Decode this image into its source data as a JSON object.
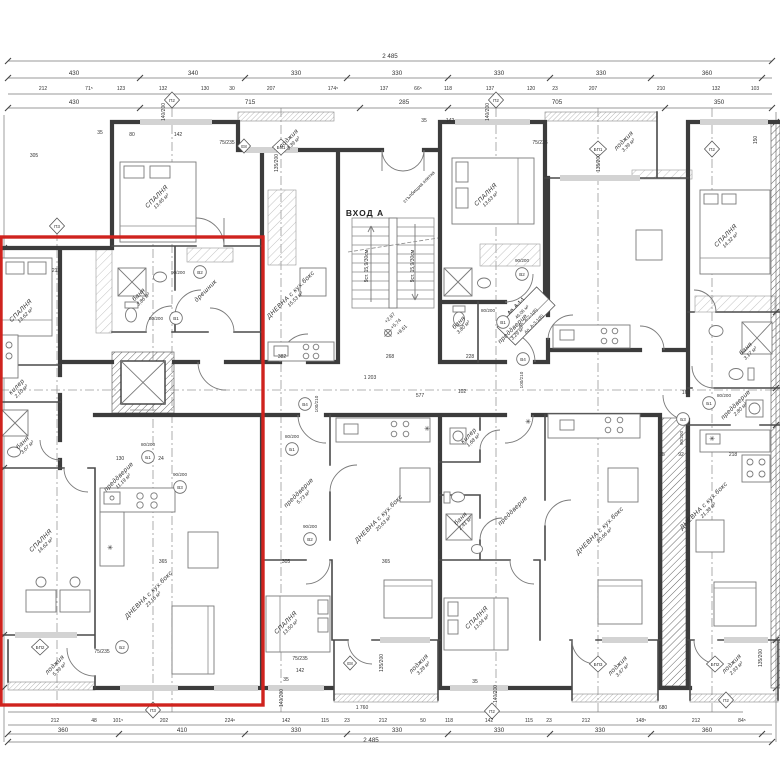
{
  "colors": {
    "highlight": "#cf231e",
    "wall": "#3c3c3c",
    "line": "#777777",
    "text": "#333333"
  },
  "entrance": {
    "label": "ВХОД А"
  },
  "annotations": [
    {
      "t": "2 485",
      "x": 390,
      "y": 58,
      "c": "dim",
      "n": "overall-dimension-top"
    },
    {
      "t": "430",
      "x": 74,
      "y": 75,
      "c": "dim"
    },
    {
      "t": "340",
      "x": 193,
      "y": 75,
      "c": "dim"
    },
    {
      "t": "330",
      "x": 296,
      "y": 75,
      "c": "dim"
    },
    {
      "t": "330",
      "x": 397,
      "y": 75,
      "c": "dim"
    },
    {
      "t": "330",
      "x": 499,
      "y": 75,
      "c": "dim"
    },
    {
      "t": "330",
      "x": 601,
      "y": 75,
      "c": "dim"
    },
    {
      "t": "360",
      "x": 707,
      "y": 75,
      "c": "dim"
    },
    {
      "t": "212",
      "x": 43,
      "y": 90,
      "c": "sm"
    },
    {
      "t": "71⁵",
      "x": 89,
      "y": 90,
      "c": "sm"
    },
    {
      "t": "123",
      "x": 121,
      "y": 90,
      "c": "sm"
    },
    {
      "t": "132",
      "x": 163,
      "y": 90,
      "c": "sm"
    },
    {
      "t": "130",
      "x": 205,
      "y": 90,
      "c": "sm"
    },
    {
      "t": "30",
      "x": 232,
      "y": 90,
      "c": "sm"
    },
    {
      "t": "207",
      "x": 271,
      "y": 90,
      "c": "sm"
    },
    {
      "t": "174⁵",
      "x": 333,
      "y": 90,
      "c": "sm"
    },
    {
      "t": "137",
      "x": 384,
      "y": 90,
      "c": "sm"
    },
    {
      "t": "66⁵",
      "x": 418,
      "y": 90,
      "c": "sm"
    },
    {
      "t": "118",
      "x": 448,
      "y": 90,
      "c": "sm"
    },
    {
      "t": "137",
      "x": 490,
      "y": 90,
      "c": "sm"
    },
    {
      "t": "120",
      "x": 531,
      "y": 90,
      "c": "sm"
    },
    {
      "t": "23",
      "x": 555,
      "y": 90,
      "c": "sm"
    },
    {
      "t": "207",
      "x": 593,
      "y": 90,
      "c": "sm"
    },
    {
      "t": "210",
      "x": 661,
      "y": 90,
      "c": "sm"
    },
    {
      "t": "132",
      "x": 716,
      "y": 90,
      "c": "sm"
    },
    {
      "t": "103",
      "x": 755,
      "y": 90,
      "c": "sm"
    },
    {
      "t": "430",
      "x": 74,
      "y": 104,
      "c": "dim"
    },
    {
      "t": "715",
      "x": 250,
      "y": 104,
      "c": "dim"
    },
    {
      "t": "285",
      "x": 404,
      "y": 104,
      "c": "dim"
    },
    {
      "t": "705",
      "x": 557,
      "y": 104,
      "c": "dim"
    },
    {
      "t": "350",
      "x": 719,
      "y": 104,
      "c": "dim"
    },
    {
      "t": "1 760",
      "x": 362,
      "y": 709,
      "c": "sm"
    },
    {
      "t": "680",
      "x": 663,
      "y": 709,
      "c": "sm"
    },
    {
      "t": "212",
      "x": 55,
      "y": 722,
      "c": "sm"
    },
    {
      "t": "48",
      "x": 94,
      "y": 722,
      "c": "sm"
    },
    {
      "t": "101⁵",
      "x": 118,
      "y": 722,
      "c": "sm"
    },
    {
      "t": "202",
      "x": 164,
      "y": 722,
      "c": "sm"
    },
    {
      "t": "224⁶",
      "x": 230,
      "y": 722,
      "c": "sm"
    },
    {
      "t": "142",
      "x": 286,
      "y": 722,
      "c": "sm"
    },
    {
      "t": "115",
      "x": 325,
      "y": 722,
      "c": "sm"
    },
    {
      "t": "23",
      "x": 347,
      "y": 722,
      "c": "sm"
    },
    {
      "t": "212",
      "x": 383,
      "y": 722,
      "c": "sm"
    },
    {
      "t": "50",
      "x": 423,
      "y": 722,
      "c": "sm"
    },
    {
      "t": "118",
      "x": 449,
      "y": 722,
      "c": "sm"
    },
    {
      "t": "142",
      "x": 489,
      "y": 722,
      "c": "sm"
    },
    {
      "t": "115",
      "x": 529,
      "y": 722,
      "c": "sm"
    },
    {
      "t": "23",
      "x": 549,
      "y": 722,
      "c": "sm"
    },
    {
      "t": "212",
      "x": 586,
      "y": 722,
      "c": "sm"
    },
    {
      "t": "148⁵",
      "x": 641,
      "y": 722,
      "c": "sm"
    },
    {
      "t": "212",
      "x": 696,
      "y": 722,
      "c": "sm"
    },
    {
      "t": "84⁵",
      "x": 742,
      "y": 722,
      "c": "sm"
    },
    {
      "t": "360",
      "x": 63,
      "y": 732,
      "c": "dim"
    },
    {
      "t": "410",
      "x": 182,
      "y": 732,
      "c": "dim"
    },
    {
      "t": "330",
      "x": 296,
      "y": 732,
      "c": "dim"
    },
    {
      "t": "330",
      "x": 397,
      "y": 732,
      "c": "dim"
    },
    {
      "t": "330",
      "x": 499,
      "y": 732,
      "c": "dim"
    },
    {
      "t": "330",
      "x": 600,
      "y": 732,
      "c": "dim"
    },
    {
      "t": "360",
      "x": 707,
      "y": 732,
      "c": "dim"
    },
    {
      "t": "2 485",
      "x": 371,
      "y": 742,
      "c": "dim",
      "n": "overall-dimension-bottom"
    },
    {
      "t": "СПАЛНЯ",
      "t2": "13,62 м²",
      "x": 22,
      "y": 312,
      "r": -45,
      "c": "room",
      "n": "room-label"
    },
    {
      "t": "СПАЛНЯ",
      "t2": "13,45 м²",
      "x": 158,
      "y": 198,
      "r": -45,
      "c": "room",
      "n": "room-label"
    },
    {
      "t": "лоджия",
      "t2": "3,39 м²",
      "x": 290,
      "y": 140,
      "r": -45,
      "c": "room",
      "n": "room-label"
    },
    {
      "t": "ДНЕВНА с кух.бокс",
      "t2": "15,53 м²",
      "x": 292,
      "y": 296,
      "r": -45,
      "c": "room",
      "n": "room-label"
    },
    {
      "t": "СПАЛНЯ",
      "t2": "13,63 м²",
      "x": 487,
      "y": 196,
      "r": -45,
      "c": "room",
      "n": "room-label"
    },
    {
      "t": "лоджия",
      "t2": "3,39 м²",
      "x": 625,
      "y": 142,
      "r": -45,
      "c": "room",
      "n": "room-label"
    },
    {
      "t": "СПАЛНЯ",
      "t2": "14,32 м²",
      "x": 727,
      "y": 237,
      "r": -45,
      "c": "room",
      "n": "room-label"
    },
    {
      "t": "баня",
      "t2": "3,86 м²",
      "x": 140,
      "y": 296,
      "r": -45,
      "c": "room",
      "n": "room-label"
    },
    {
      "t": "дрешник",
      "x": 207,
      "y": 292,
      "r": -45,
      "c": "room",
      "n": "room-label"
    },
    {
      "t": "баня",
      "t2": "3,80 м²",
      "x": 460,
      "y": 324,
      "r": -45,
      "c": "room",
      "n": "room-label"
    },
    {
      "t": "преддверие",
      "t2": "3,29 м²",
      "x": 514,
      "y": 330,
      "r": -45,
      "c": "room",
      "n": "room-label"
    },
    {
      "t": "баня",
      "t2": "3,17 м²",
      "x": 747,
      "y": 350,
      "r": -45,
      "c": "room",
      "n": "room-label"
    },
    {
      "t": "преддверие",
      "t2": "2,80 м²",
      "x": 737,
      "y": 406,
      "r": -45,
      "c": "room",
      "n": "room-label"
    },
    {
      "t": "килер",
      "t2": "2,10 м²",
      "x": 18,
      "y": 388,
      "r": -45,
      "c": "room",
      "n": "room-label"
    },
    {
      "t": "баня",
      "t2": "3,67 м²",
      "x": 24,
      "y": 444,
      "r": -45,
      "c": "room",
      "n": "room-label"
    },
    {
      "t": "преддверие",
      "t2": "11,19 м²",
      "x": 120,
      "y": 478,
      "r": -45,
      "c": "room",
      "n": "room-label"
    },
    {
      "t": "СПАЛНЯ",
      "t2": "14,62 м²",
      "x": 42,
      "y": 542,
      "r": -45,
      "c": "room",
      "n": "room-label"
    },
    {
      "t": "ДНЕВНА с кух.бокс",
      "t2": "23,16 м²",
      "x": 150,
      "y": 596,
      "r": -45,
      "c": "room",
      "n": "room-label"
    },
    {
      "t": "лоджия",
      "t2": "5,39 м²",
      "x": 56,
      "y": 666,
      "r": -45,
      "c": "room",
      "n": "room-label"
    },
    {
      "t": "преддверие",
      "t2": "5,73 м²",
      "x": 300,
      "y": 494,
      "r": -45,
      "c": "room",
      "n": "room-label"
    },
    {
      "t": "ДНЕВНА с кух.бокс",
      "t2": "20,63 м²",
      "x": 380,
      "y": 520,
      "r": -45,
      "c": "room",
      "n": "room-label"
    },
    {
      "t": "килер",
      "t2": "1,68 м²",
      "x": 470,
      "y": 437,
      "r": -45,
      "c": "room",
      "n": "room-label"
    },
    {
      "t": "баня",
      "t2": "2,41 м²",
      "x": 462,
      "y": 520,
      "r": -45,
      "c": "room",
      "n": "room-label"
    },
    {
      "t": "СПАЛНЯ",
      "t2": "13,50 м²",
      "x": 287,
      "y": 624,
      "r": -45,
      "c": "room",
      "n": "room-label"
    },
    {
      "t": "лоджия",
      "t2": "3,28 м²",
      "x": 420,
      "y": 665,
      "r": -45,
      "c": "room",
      "n": "room-label"
    },
    {
      "t": "СПАЛНЯ",
      "t2": "13,04 м²",
      "x": 478,
      "y": 619,
      "r": -45,
      "c": "room",
      "n": "room-label"
    },
    {
      "t": "преддверие",
      "x": 514,
      "y": 512,
      "r": -45,
      "c": "room",
      "n": "room-label"
    },
    {
      "t": "ДНЕВНА с кух.бокс",
      "t2": "20,66 м²",
      "x": 601,
      "y": 532,
      "r": -45,
      "c": "room",
      "n": "room-label"
    },
    {
      "t": "лоджия",
      "t2": "3,47 м²",
      "x": 619,
      "y": 667,
      "r": -45,
      "c": "room",
      "n": "room-label"
    },
    {
      "t": "ДНЕВНА с кух.бокс",
      "t2": "21,38 м²",
      "x": 705,
      "y": 507,
      "r": -45,
      "c": "room",
      "n": "room-label"
    },
    {
      "t": "лоджия",
      "t2": "2,93 м²",
      "x": 733,
      "y": 665,
      "r": -45,
      "c": "room",
      "n": "room-label"
    },
    {
      "t": "стълбищна клетка",
      "x": 420,
      "y": 188,
      "r": -45,
      "c": "sm",
      "n": "stair-note"
    },
    {
      "t": "9ст. 15,9/30см",
      "x": 368,
      "y": 266,
      "r": -90,
      "c": "sm",
      "n": "stair-note"
    },
    {
      "t": "9ст. 15,9/30см",
      "x": 414,
      "y": 266,
      "r": -90,
      "c": "sm",
      "n": "stair-note"
    },
    {
      "t": "+2,87",
      "x": 391,
      "y": 319,
      "r": -45,
      "c": "sm",
      "n": "elevation-label"
    },
    {
      "t": "+5,74",
      "x": 397,
      "y": 325,
      "r": -45,
      "c": "sm",
      "n": "elevation-label"
    },
    {
      "t": "+8,61",
      "x": 403,
      "y": 331,
      "r": -45,
      "c": "sm",
      "n": "elevation-label"
    },
    {
      "t": "Ап. А-1-1",
      "x": 517,
      "y": 307,
      "r": -45,
      "c": "mkb",
      "n": "apartment-id-label"
    },
    {
      "t": "46,06 м²",
      "x": 523,
      "y": 313,
      "r": -45,
      "c": "mk",
      "n": "apartment-area-label"
    },
    {
      "t": "Ап. А-2-1(В)",
      "x": 529,
      "y": 319,
      "r": -45,
      "c": "mk",
      "n": "apartment-id-label"
    },
    {
      "t": "Ап. А-3-1(В)",
      "x": 535,
      "y": 325,
      "r": -45,
      "c": "mk",
      "n": "apartment-id-label"
    },
    {
      "t": "35",
      "x": 100,
      "y": 134,
      "c": "sm"
    },
    {
      "t": "142",
      "x": 178,
      "y": 136,
      "c": "sm"
    },
    {
      "t": "80",
      "x": 132,
      "y": 136,
      "c": "sm"
    },
    {
      "t": "305",
      "x": 34,
      "y": 157,
      "c": "sm"
    },
    {
      "t": "212",
      "x": 56,
      "y": 272,
      "c": "sm"
    },
    {
      "t": "35",
      "x": 424,
      "y": 122,
      "c": "sm"
    },
    {
      "t": "142",
      "x": 450,
      "y": 122,
      "c": "sm"
    },
    {
      "t": "1 203",
      "x": 370,
      "y": 379,
      "c": "sm"
    },
    {
      "t": "382",
      "x": 282,
      "y": 358,
      "c": "sm"
    },
    {
      "t": "268",
      "x": 390,
      "y": 358,
      "c": "sm"
    },
    {
      "t": "228",
      "x": 470,
      "y": 358,
      "c": "sm"
    },
    {
      "t": "577",
      "x": 420,
      "y": 397,
      "c": "sm"
    },
    {
      "t": "102",
      "x": 462,
      "y": 393,
      "c": "sm"
    },
    {
      "t": "130",
      "x": 120,
      "y": 460,
      "c": "sm"
    },
    {
      "t": "24",
      "x": 161,
      "y": 460,
      "c": "sm"
    },
    {
      "t": "365",
      "x": 163,
      "y": 563,
      "c": "sm"
    },
    {
      "t": "305",
      "x": 286,
      "y": 563,
      "c": "sm"
    },
    {
      "t": "365",
      "x": 386,
      "y": 563,
      "c": "sm"
    },
    {
      "t": "142",
      "x": 300,
      "y": 672,
      "c": "sm"
    },
    {
      "t": "35",
      "x": 286,
      "y": 681,
      "c": "sm"
    },
    {
      "t": "35",
      "x": 475,
      "y": 683,
      "c": "sm"
    },
    {
      "t": "163",
      "x": 686,
      "y": 394,
      "c": "sm"
    },
    {
      "t": "218",
      "x": 733,
      "y": 456,
      "c": "sm"
    },
    {
      "t": "92",
      "x": 681,
      "y": 456,
      "c": "sm"
    },
    {
      "t": "25",
      "x": 662,
      "y": 456,
      "c": "sm"
    },
    {
      "t": "150",
      "x": 757,
      "y": 140,
      "r": -90,
      "c": "sm"
    },
    {
      "t": "140/200",
      "x": 165,
      "y": 112,
      "r": -90,
      "c": "sm",
      "n": "door-size-label"
    },
    {
      "t": "140/200",
      "x": 489,
      "y": 112,
      "r": -90,
      "c": "sm",
      "n": "door-size-label"
    },
    {
      "t": "135/200",
      "x": 278,
      "y": 163,
      "r": -90,
      "c": "sm",
      "n": "door-size-label"
    },
    {
      "t": "135/200",
      "x": 600,
      "y": 163,
      "r": -90,
      "c": "sm",
      "n": "door-size-label"
    },
    {
      "t": "75/235",
      "x": 227,
      "y": 144,
      "c": "sm",
      "n": "door-size-label"
    },
    {
      "t": "75/235",
      "x": 540,
      "y": 144,
      "c": "sm",
      "n": "door-size-label"
    },
    {
      "t": "75/235",
      "x": 102,
      "y": 653,
      "c": "sm",
      "n": "door-size-label"
    },
    {
      "t": "75/235",
      "x": 300,
      "y": 660,
      "c": "sm",
      "n": "door-size-label"
    },
    {
      "t": "135/200",
      "x": 383,
      "y": 663,
      "r": -90,
      "c": "sm",
      "n": "door-size-label"
    },
    {
      "t": "135/200",
      "x": 762,
      "y": 658,
      "r": -90,
      "c": "sm",
      "n": "door-size-label"
    },
    {
      "t": "140/200",
      "x": 283,
      "y": 698,
      "r": -90,
      "c": "sm",
      "n": "door-size-label"
    },
    {
      "t": "140/200",
      "x": 497,
      "y": 694,
      "r": -90,
      "c": "sm",
      "n": "door-size-label"
    },
    {
      "t": "В2",
      "x": 200,
      "y": 274,
      "c": "mk",
      "n": "door-marker"
    },
    {
      "t": "90/200",
      "x": 178,
      "y": 274,
      "c": "mk",
      "n": "door-size-label"
    },
    {
      "t": "В1",
      "x": 176,
      "y": 320,
      "c": "mk",
      "n": "door-marker"
    },
    {
      "t": "80/200",
      "x": 156,
      "y": 320,
      "c": "mk",
      "n": "door-size-label"
    },
    {
      "t": "Б1",
      "x": 148,
      "y": 459,
      "c": "mk",
      "n": "door-marker"
    },
    {
      "t": "80/200",
      "x": 148,
      "y": 446,
      "c": "mk",
      "n": "door-size-label"
    },
    {
      "t": "В3",
      "x": 180,
      "y": 489,
      "c": "mk",
      "n": "door-marker"
    },
    {
      "t": "90/200",
      "x": 180,
      "y": 476,
      "c": "mk",
      "n": "door-size-label"
    },
    {
      "t": "Б1",
      "x": 292,
      "y": 451,
      "c": "mk",
      "n": "door-marker"
    },
    {
      "t": "80/200",
      "x": 292,
      "y": 438,
      "c": "mk",
      "n": "door-size-label"
    },
    {
      "t": "В2",
      "x": 310,
      "y": 541,
      "c": "mk",
      "n": "door-marker"
    },
    {
      "t": "90/200",
      "x": 310,
      "y": 528,
      "c": "mk",
      "n": "door-size-label"
    },
    {
      "t": "В4",
      "x": 305,
      "y": 406,
      "c": "mk",
      "n": "door-marker"
    },
    {
      "t": "100/210",
      "x": 318,
      "y": 404,
      "r": -90,
      "c": "mk",
      "n": "door-size-label"
    },
    {
      "t": "В4",
      "x": 523,
      "y": 361,
      "c": "mk",
      "n": "door-marker"
    },
    {
      "t": "100/210",
      "x": 523,
      "y": 380,
      "r": -90,
      "c": "mk",
      "n": "door-size-label"
    },
    {
      "t": "В1",
      "x": 503,
      "y": 324,
      "c": "mk",
      "n": "door-marker"
    },
    {
      "t": "80/200",
      "x": 488,
      "y": 312,
      "c": "mk",
      "n": "door-size-label"
    },
    {
      "t": "В2",
      "x": 522,
      "y": 276,
      "c": "mk",
      "n": "door-marker"
    },
    {
      "t": "90/200",
      "x": 522,
      "y": 262,
      "c": "mk",
      "n": "door-size-label"
    },
    {
      "t": "Б3",
      "x": 683,
      "y": 421,
      "c": "mk",
      "n": "door-marker"
    },
    {
      "t": "90/200",
      "x": 683,
      "y": 438,
      "r": -90,
      "c": "mk",
      "n": "door-size-label"
    },
    {
      "t": "Б1",
      "x": 709,
      "y": 405,
      "c": "mk",
      "n": "door-marker"
    },
    {
      "t": "80/200",
      "x": 724,
      "y": 397,
      "c": "mk",
      "n": "door-size-label"
    },
    {
      "t": "Б2",
      "x": 122,
      "y": 649,
      "c": "mk",
      "n": "door-marker"
    },
    {
      "t": "П2",
      "x": 172,
      "y": 102,
      "c": "mk",
      "n": "axis-marker"
    },
    {
      "t": "П2",
      "x": 496,
      "y": 102,
      "c": "mk",
      "n": "axis-marker"
    },
    {
      "t": "П2",
      "x": 712,
      "y": 151,
      "c": "mk",
      "n": "axis-marker"
    },
    {
      "t": "П3",
      "x": 57,
      "y": 228,
      "c": "mk",
      "n": "axis-marker"
    },
    {
      "t": "БП1",
      "x": 281,
      "y": 149,
      "c": "mk",
      "n": "axis-marker"
    },
    {
      "t": "БП1",
      "x": 598,
      "y": 151,
      "c": "mk",
      "n": "axis-marker"
    },
    {
      "t": "БП2",
      "x": 40,
      "y": 649,
      "c": "mk",
      "n": "axis-marker"
    },
    {
      "t": "БП3",
      "x": 598,
      "y": 666,
      "c": "mk",
      "n": "axis-marker"
    },
    {
      "t": "БП2",
      "x": 715,
      "y": 666,
      "c": "mk",
      "n": "axis-marker"
    },
    {
      "t": "П3",
      "x": 153,
      "y": 712,
      "c": "mk",
      "n": "axis-marker"
    },
    {
      "t": "П2",
      "x": 492,
      "y": 713,
      "c": "mk",
      "n": "axis-marker"
    },
    {
      "t": "П2",
      "x": 726,
      "y": 702,
      "c": "mk",
      "n": "axis-marker"
    },
    {
      "t": "Е8",
      "x": 244,
      "y": 148,
      "c": "mk",
      "n": "axis-marker"
    },
    {
      "t": "Е8",
      "x": 350,
      "y": 665,
      "c": "mk",
      "n": "axis-marker"
    },
    {
      "t": "✳",
      "x": 110,
      "y": 550,
      "c": "star",
      "n": "boiler-icon"
    },
    {
      "t": "✳",
      "x": 427,
      "y": 431,
      "c": "star",
      "n": "boiler-icon"
    },
    {
      "t": "✳",
      "x": 528,
      "y": 424,
      "c": "star",
      "n": "boiler-icon"
    },
    {
      "t": "✳",
      "x": 712,
      "y": 441,
      "c": "star",
      "n": "boiler-icon"
    }
  ]
}
